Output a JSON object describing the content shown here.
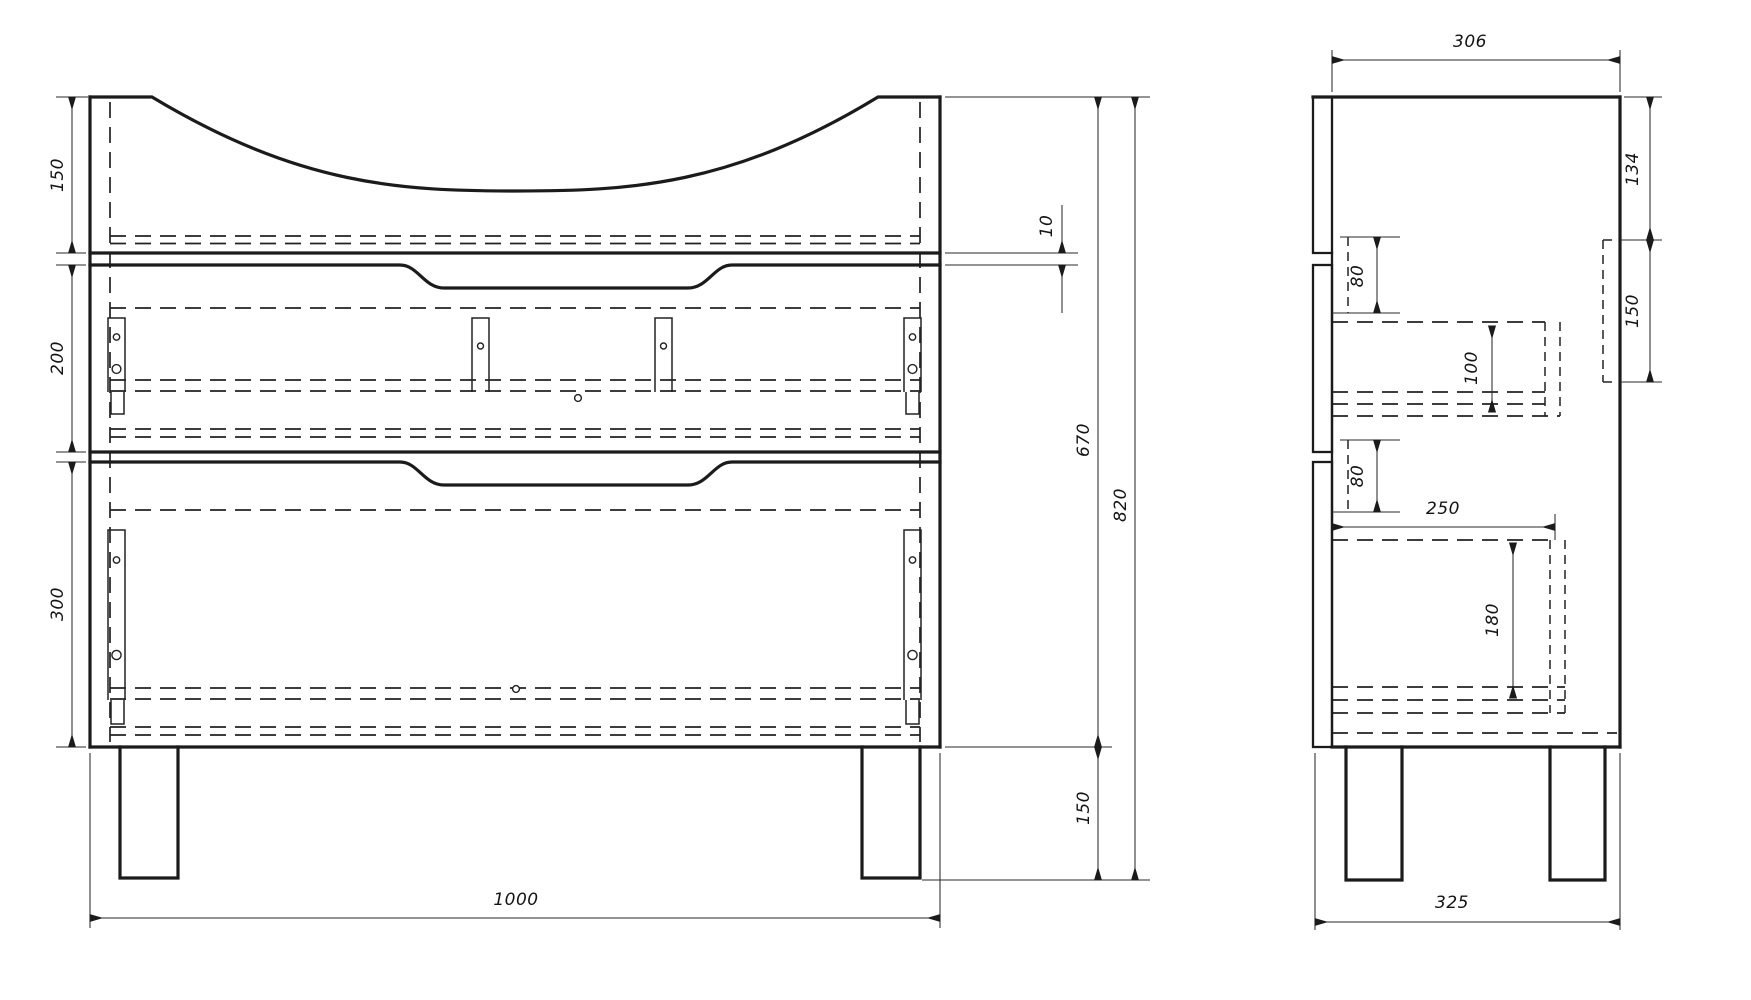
{
  "drawing": {
    "type": "technical-orthographic-drawing",
    "subject": "two-drawer washbasin vanity cabinet, front view and side view",
    "background_color": "#ffffff",
    "line_color": "#1b1b1b",
    "views": {
      "front": "front-view",
      "side": "side-view"
    },
    "dimensions": {
      "front": {
        "top_section_height": "150",
        "drawer1_height": "200",
        "drawer2_height": "300",
        "top_gap": "10",
        "carcass_height": "670",
        "overall_height": "820",
        "leg_height": "150",
        "overall_width": "1000"
      },
      "side": {
        "carcass_depth": "306",
        "back_rail_offset": "134",
        "back_rail_height": "150",
        "upper_slide_offset": "80",
        "drawer1_box_height": "100",
        "lower_slide_offset": "80",
        "drawer2_box_depth": "250",
        "drawer2_box_height": "180",
        "overall_depth": "325"
      }
    }
  }
}
